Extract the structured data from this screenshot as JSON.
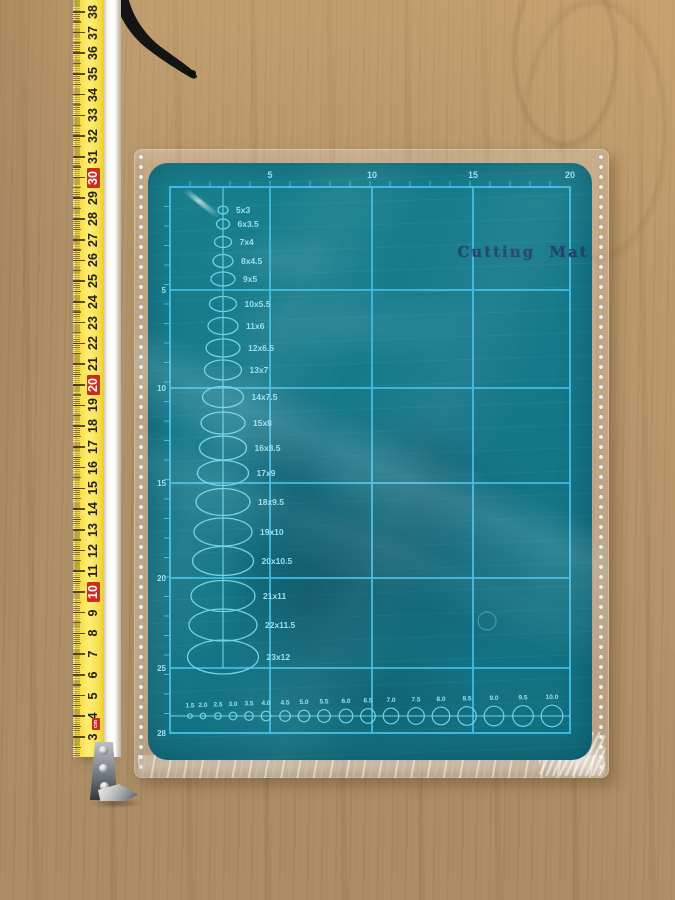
{
  "tape_measure": {
    "unit_label": "cm",
    "scale_min": 3,
    "scale_max": 38,
    "red_values": [
      10,
      20,
      30
    ],
    "colors": {
      "body_yellow": "#f7dd49",
      "highlight_red": "#cf2b1d",
      "digits": "#241f12"
    }
  },
  "mat": {
    "title": "Cutting Mat",
    "top_scale": [
      "5",
      "10",
      "15",
      "20"
    ],
    "left_scale": [
      "5",
      "10",
      "15",
      "20",
      "25",
      "28"
    ],
    "ellipses": [
      {
        "label": "5x3",
        "cy": 47,
        "w": 10,
        "h": 8
      },
      {
        "label": "6x3.5",
        "cy": 61,
        "w": 13,
        "h": 10
      },
      {
        "label": "7x4",
        "cy": 79,
        "w": 17,
        "h": 11
      },
      {
        "label": "8x4.5",
        "cy": 98,
        "w": 20,
        "h": 13
      },
      {
        "label": "9x5",
        "cy": 116,
        "w": 24,
        "h": 14
      },
      {
        "label": "10x5.5",
        "cy": 141,
        "w": 27,
        "h": 15
      },
      {
        "label": "11x6",
        "cy": 163,
        "w": 30,
        "h": 17
      },
      {
        "label": "12x6.5",
        "cy": 185,
        "w": 34,
        "h": 18
      },
      {
        "label": "13x7",
        "cy": 207,
        "w": 37,
        "h": 20
      },
      {
        "label": "14x7.5",
        "cy": 234,
        "w": 41,
        "h": 21
      },
      {
        "label": "15x8",
        "cy": 260,
        "w": 44,
        "h": 22
      },
      {
        "label": "16x8.5",
        "cy": 285,
        "w": 47,
        "h": 24
      },
      {
        "label": "17x9",
        "cy": 310,
        "w": 51,
        "h": 25
      },
      {
        "label": "18x9.5",
        "cy": 339,
        "w": 54,
        "h": 27
      },
      {
        "label": "19x10",
        "cy": 369,
        "w": 58,
        "h": 28
      },
      {
        "label": "20x10.5",
        "cy": 398,
        "w": 61,
        "h": 29
      },
      {
        "label": "21x11",
        "cy": 433,
        "w": 64,
        "h": 31
      },
      {
        "label": "22x11.5",
        "cy": 462,
        "w": 68,
        "h": 32
      },
      {
        "label": "23x12",
        "cy": 494,
        "w": 71,
        "h": 34
      }
    ],
    "circles": [
      {
        "label": "1.5",
        "cx": 42,
        "r": 2.3
      },
      {
        "label": "2.0",
        "cx": 55,
        "r": 2.8
      },
      {
        "label": "2.5",
        "cx": 70,
        "r": 3.3
      },
      {
        "label": "3.0",
        "cx": 85,
        "r": 3.8
      },
      {
        "label": "3.5",
        "cx": 101,
        "r": 4.3
      },
      {
        "label": "4.0",
        "cx": 118,
        "r": 4.8
      },
      {
        "label": "4.5",
        "cx": 137,
        "r": 5.3
      },
      {
        "label": "5.0",
        "cx": 156,
        "r": 5.8
      },
      {
        "label": "5.5",
        "cx": 176,
        "r": 6.3
      },
      {
        "label": "6.0",
        "cx": 198,
        "r": 6.8
      },
      {
        "label": "6.5",
        "cx": 220,
        "r": 7.3
      },
      {
        "label": "7.0",
        "cx": 243,
        "r": 7.8
      },
      {
        "label": "7.5",
        "cx": 268,
        "r": 8.3
      },
      {
        "label": "8.0",
        "cx": 293,
        "r": 8.8
      },
      {
        "label": "8.5",
        "cx": 319,
        "r": 9.3
      },
      {
        "label": "9.0",
        "cx": 346,
        "r": 9.8
      },
      {
        "label": "9.5",
        "cx": 375,
        "r": 10.3
      },
      {
        "label": "10.0",
        "cx": 404,
        "r": 10.8
      }
    ],
    "colors": {
      "surface_teal": "#16788a",
      "grid_cyan": "#3fbce6",
      "label_cyan": "#97e0f0",
      "title_navy": "#21406f"
    }
  }
}
